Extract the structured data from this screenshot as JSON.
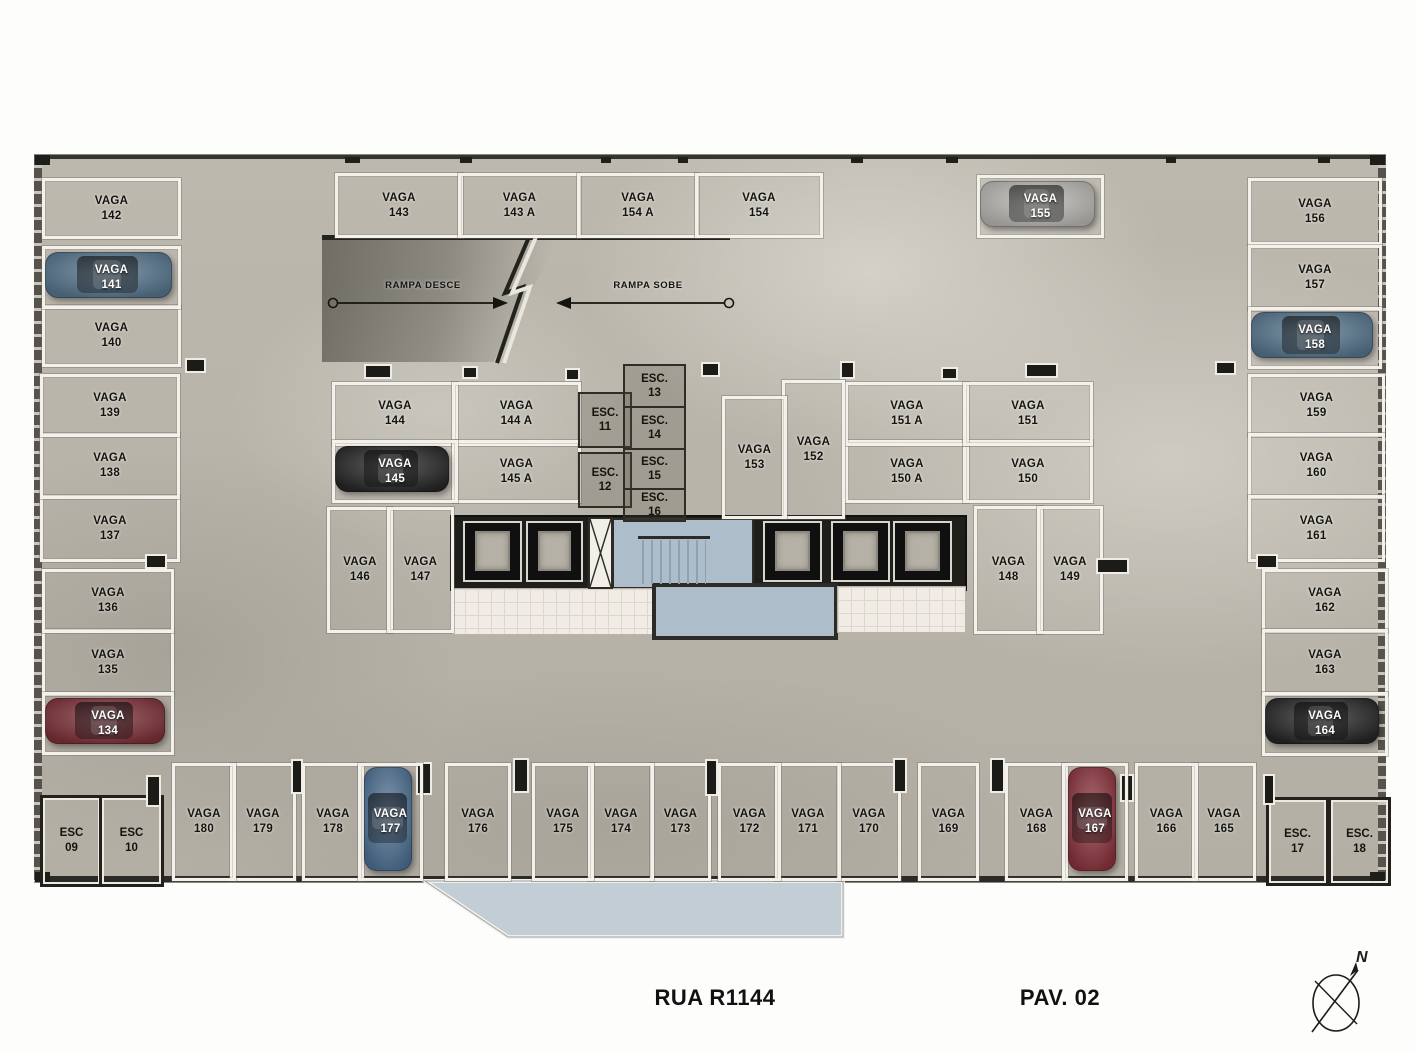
{
  "plan": {
    "street_label": "RUA R1144",
    "floor_label": "PAV. 02",
    "compass_label": "N"
  },
  "ramp": {
    "down_label": "RAMPA DESCE",
    "up_label": "RAMPA SOBE"
  },
  "stalls": [
    {
      "number": "134",
      "label": "VAGA"
    },
    {
      "number": "135",
      "label": "VAGA"
    },
    {
      "number": "136",
      "label": "VAGA"
    },
    {
      "number": "137",
      "label": "VAGA"
    },
    {
      "number": "138",
      "label": "VAGA"
    },
    {
      "number": "139",
      "label": "VAGA"
    },
    {
      "number": "140",
      "label": "VAGA"
    },
    {
      "number": "141",
      "label": "VAGA"
    },
    {
      "number": "142",
      "label": "VAGA"
    },
    {
      "number": "143",
      "label": "VAGA"
    },
    {
      "number": "143 A",
      "label": "VAGA"
    },
    {
      "number": "154 A",
      "label": "VAGA"
    },
    {
      "number": "154",
      "label": "VAGA"
    },
    {
      "number": "155",
      "label": "VAGA"
    },
    {
      "number": "144",
      "label": "VAGA"
    },
    {
      "number": "144 A",
      "label": "VAGA"
    },
    {
      "number": "145",
      "label": "VAGA"
    },
    {
      "number": "145 A",
      "label": "VAGA"
    },
    {
      "number": "146",
      "label": "VAGA"
    },
    {
      "number": "147",
      "label": "VAGA"
    },
    {
      "number": "148",
      "label": "VAGA"
    },
    {
      "number": "149",
      "label": "VAGA"
    },
    {
      "number": "150 A",
      "label": "VAGA"
    },
    {
      "number": "150",
      "label": "VAGA"
    },
    {
      "number": "151 A",
      "label": "VAGA"
    },
    {
      "number": "151",
      "label": "VAGA"
    },
    {
      "number": "152",
      "label": "VAGA"
    },
    {
      "number": "153",
      "label": "VAGA"
    },
    {
      "number": "156",
      "label": "VAGA"
    },
    {
      "number": "157",
      "label": "VAGA"
    },
    {
      "number": "158",
      "label": "VAGA"
    },
    {
      "number": "159",
      "label": "VAGA"
    },
    {
      "number": "160",
      "label": "VAGA"
    },
    {
      "number": "161",
      "label": "VAGA"
    },
    {
      "number": "162",
      "label": "VAGA"
    },
    {
      "number": "163",
      "label": "VAGA"
    },
    {
      "number": "164",
      "label": "VAGA"
    },
    {
      "number": "165",
      "label": "VAGA"
    },
    {
      "number": "166",
      "label": "VAGA"
    },
    {
      "number": "167",
      "label": "VAGA"
    },
    {
      "number": "168",
      "label": "VAGA"
    },
    {
      "number": "169",
      "label": "VAGA"
    },
    {
      "number": "170",
      "label": "VAGA"
    },
    {
      "number": "171",
      "label": "VAGA"
    },
    {
      "number": "172",
      "label": "VAGA"
    },
    {
      "number": "173",
      "label": "VAGA"
    },
    {
      "number": "174",
      "label": "VAGA"
    },
    {
      "number": "175",
      "label": "VAGA"
    },
    {
      "number": "176",
      "label": "VAGA"
    },
    {
      "number": "177",
      "label": "VAGA"
    },
    {
      "number": "178",
      "label": "VAGA"
    },
    {
      "number": "179",
      "label": "VAGA"
    },
    {
      "number": "180",
      "label": "VAGA"
    }
  ],
  "stairs": [
    {
      "number": "09",
      "label": "ESC"
    },
    {
      "number": "10",
      "label": "ESC"
    },
    {
      "number": "11",
      "label": "ESC."
    },
    {
      "number": "12",
      "label": "ESC."
    },
    {
      "number": "13",
      "label": "ESC."
    },
    {
      "number": "14",
      "label": "ESC."
    },
    {
      "number": "15",
      "label": "ESC."
    },
    {
      "number": "16",
      "label": "ESC."
    },
    {
      "number": "17",
      "label": "ESC."
    },
    {
      "number": "18",
      "label": "ESC."
    }
  ],
  "cars": [
    {
      "stall": "141",
      "color_name": "blue",
      "color": "#56748c"
    },
    {
      "stall": "134",
      "color_name": "dark-red",
      "color": "#7c3038"
    },
    {
      "stall": "145",
      "color_name": "black",
      "color": "#262626"
    },
    {
      "stall": "155",
      "color_name": "silver",
      "color": "#b7b6b1"
    },
    {
      "stall": "158",
      "color_name": "blue",
      "color": "#56748c"
    },
    {
      "stall": "164",
      "color_name": "black",
      "color": "#262626"
    },
    {
      "stall": "177",
      "color_name": "blue",
      "color": "#4e7092"
    },
    {
      "stall": "167",
      "color_name": "red",
      "color": "#8a333c"
    }
  ]
}
